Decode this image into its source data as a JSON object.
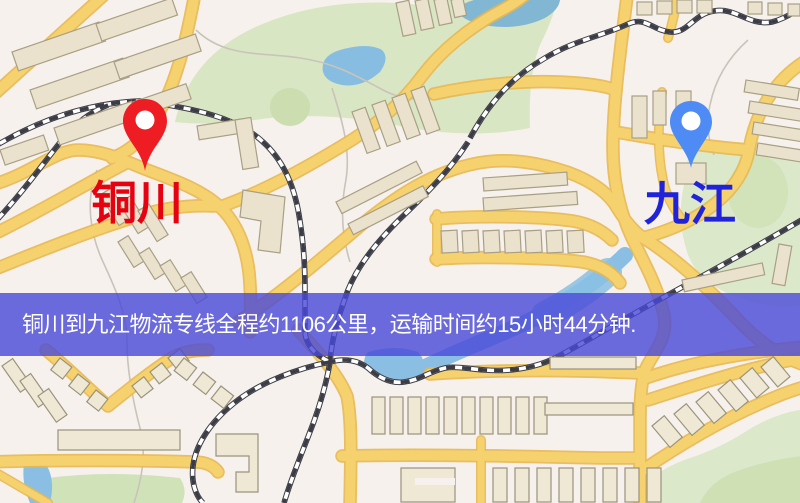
{
  "map": {
    "origin": {
      "label": "铜川",
      "label_color": "#e60211",
      "pin_color": "#ee1c23"
    },
    "destination": {
      "label": "九江",
      "label_color": "#2023d9",
      "pin_color": "#4e8bf5"
    }
  },
  "banner": {
    "text": "铜川到九江物流专线全程约1106公里，运输时间约15小时44分钟.",
    "background_color": "#4848d8",
    "text_color": "#ffffff"
  },
  "palette": {
    "map_background": "#f6f1ec",
    "road_fill": "#f6d26e",
    "road_casing": "#e8b851",
    "railway_dark": "#3c3c46",
    "railway_light": "#ffffff",
    "water": "#8abfe3",
    "pond_teal": "#82b7d4",
    "park_green": "#d9e6c3",
    "field_green": "#cfe2b8",
    "building_fill": "#eae2cc",
    "building_stroke": "#a89f85"
  }
}
